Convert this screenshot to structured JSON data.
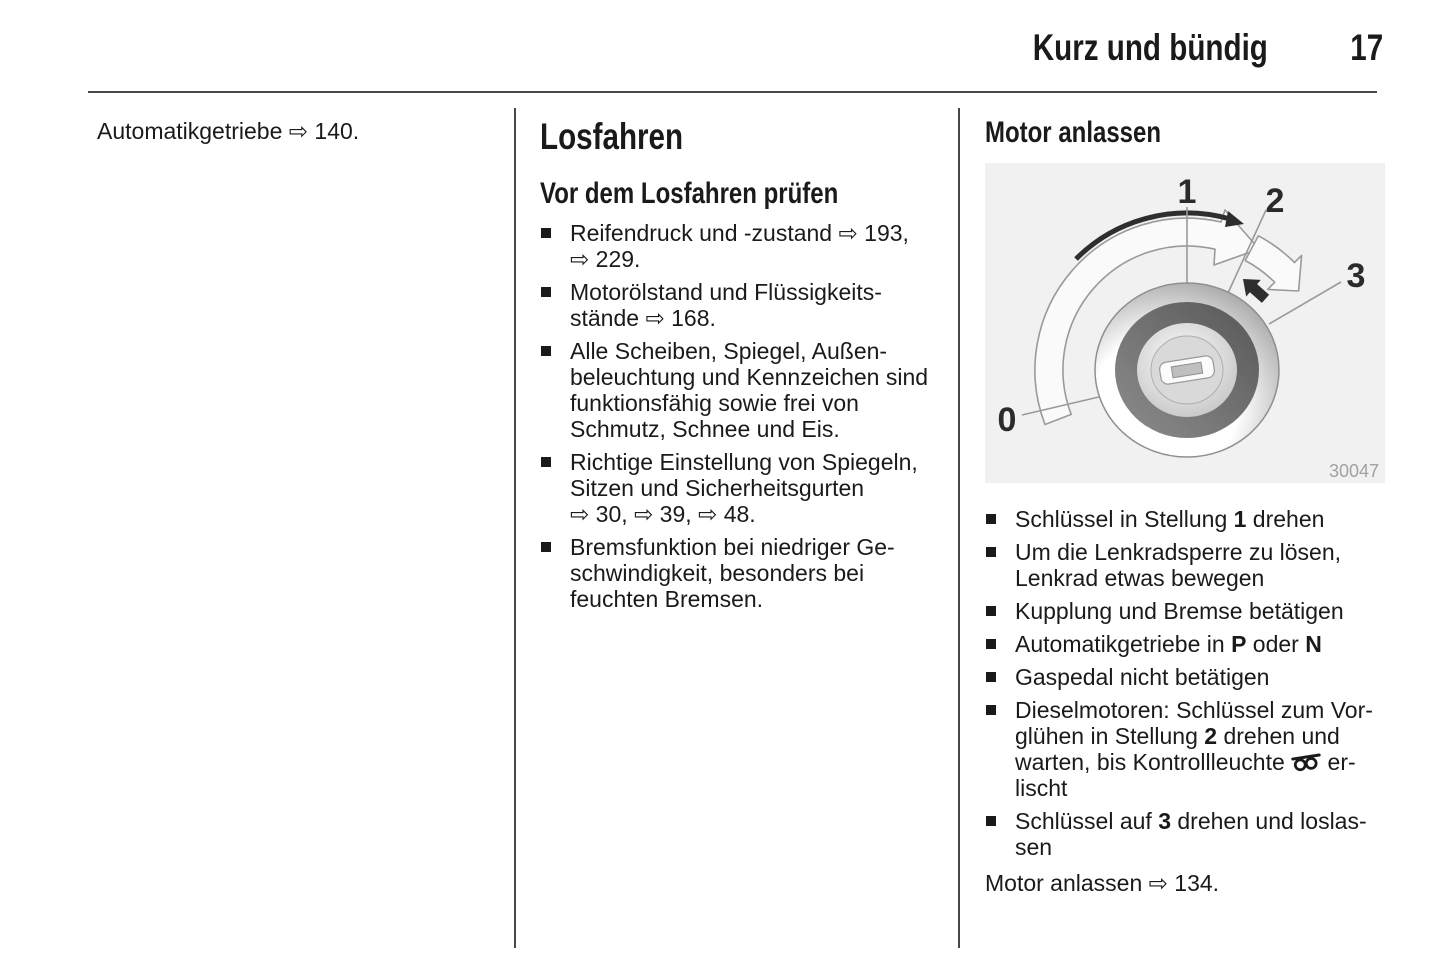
{
  "header": {
    "title": "Kurz und bündig",
    "page_number": "17"
  },
  "left_column": {
    "reference": [
      [
        {
          "t": "Automatikgetriebe ⇨ 140."
        }
      ]
    ]
  },
  "middle_column": {
    "title": "Losfahren",
    "subtitle": "Vor dem Losfahren prüfen",
    "checklist": [
      {
        "lines": [
          [
            {
              "t": "Reifendruck und -zustand ⇨ 193,"
            }
          ],
          [
            {
              "t": "⇨ 229."
            }
          ]
        ]
      },
      {
        "lines": [
          [
            {
              "t": "Motorölstand und Flüssigkeits-"
            }
          ],
          [
            {
              "t": "stände ⇨ 168."
            }
          ]
        ]
      },
      {
        "lines": [
          [
            {
              "t": "Alle Scheiben, Spiegel, Außen-"
            }
          ],
          [
            {
              "t": "beleuchtung und Kennzeichen sind"
            }
          ],
          [
            {
              "t": "funktionsfähig sowie frei von"
            }
          ],
          [
            {
              "t": "Schmutz, Schnee und Eis."
            }
          ]
        ]
      },
      {
        "lines": [
          [
            {
              "t": "Richtige Einstellung von Spiegeln,"
            }
          ],
          [
            {
              "t": "Sitzen und Sicherheitsgurten"
            }
          ],
          [
            {
              "t": "⇨ 30, ⇨ 39, ⇨ 48."
            }
          ]
        ]
      },
      {
        "lines": [
          [
            {
              "t": "Bremsfunktion bei niedriger Ge-"
            }
          ],
          [
            {
              "t": "schwindigkeit, besonders bei"
            }
          ],
          [
            {
              "t": "feuchten Bremsen."
            }
          ]
        ]
      }
    ]
  },
  "right_column": {
    "title": "Motor anlassen",
    "steps": [
      {
        "lines": [
          [
            {
              "t": "Schlüssel in Stellung "
            },
            {
              "t": "1",
              "b": true
            },
            {
              "t": " drehen"
            }
          ]
        ]
      },
      {
        "lines": [
          [
            {
              "t": "Um die Lenkradsperre zu lösen,"
            }
          ],
          [
            {
              "t": "Lenkrad etwas bewegen"
            }
          ]
        ]
      },
      {
        "lines": [
          [
            {
              "t": "Kupplung und Bremse betätigen"
            }
          ]
        ]
      },
      {
        "lines": [
          [
            {
              "t": "Automatikgetriebe in "
            },
            {
              "t": "P",
              "b": true
            },
            {
              "t": " oder "
            },
            {
              "t": "N",
              "b": true
            }
          ]
        ]
      },
      {
        "lines": [
          [
            {
              "t": "Gaspedal nicht betätigen"
            }
          ]
        ]
      },
      {
        "lines": [
          [
            {
              "t": "Dieselmotoren: Schlüssel zum Vor-"
            }
          ],
          [
            {
              "t": "glühen in Stellung "
            },
            {
              "t": "2",
              "b": true
            },
            {
              "t": " drehen und"
            }
          ],
          [
            {
              "t": "warten, bis Kontrollleuchte "
            },
            {
              "ic": "glow-plug-icon"
            },
            {
              "t": " er-"
            }
          ],
          [
            {
              "t": "lischt"
            }
          ]
        ]
      },
      {
        "lines": [
          [
            {
              "t": "Schlüssel auf "
            },
            {
              "t": "3",
              "b": true
            },
            {
              "t": " drehen und loslas-"
            }
          ],
          [
            {
              "t": "sen"
            }
          ]
        ]
      }
    ],
    "footer": [
      [
        {
          "t": "Motor anlassen ⇨ 134."
        }
      ]
    ]
  },
  "figure": {
    "position_labels": {
      "p0": "0",
      "p1": "1",
      "p2": "2",
      "p3": "3"
    },
    "figure_number": "30047"
  },
  "icons": {
    "glow_plug_indicator": "glow-plug-icon",
    "reference_arrow_glyph": "⇨"
  },
  "colors": {
    "text": "#1a1a1a",
    "rule": "#474747",
    "figure_background": "#f1f1f1",
    "figure_lines": "#9a9a9a",
    "figure_number_gray": "#a2a2a2"
  }
}
